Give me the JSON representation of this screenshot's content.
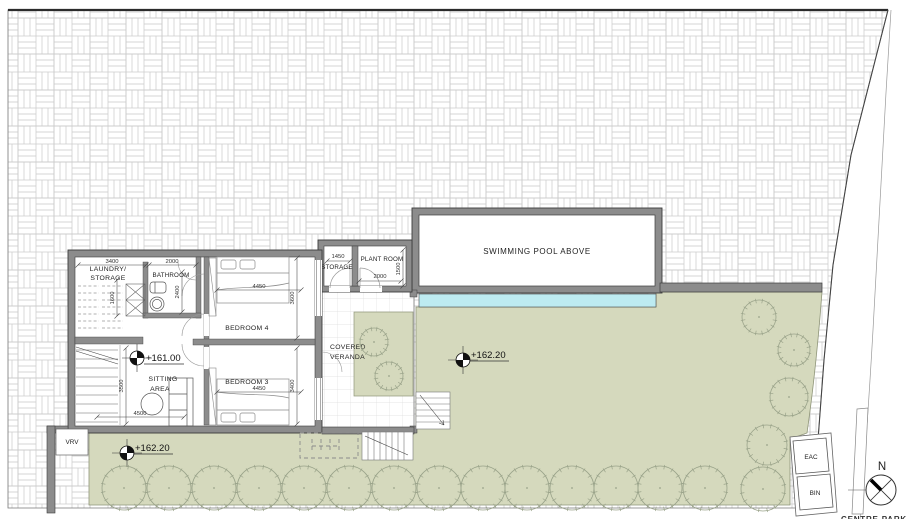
{
  "drawing": {
    "type": "architectural floor / site plan",
    "caption_bottom": "CENTRE PARK",
    "north_label": "N"
  },
  "rooms": {
    "laundry_line1": "LAUNDRY/",
    "laundry_line2": "STORAGE",
    "bathroom": "BATHROOM",
    "bedroom4": "BEDROOM 4",
    "bedroom3": "BEDROOM 3",
    "sitting_line1": "SITTING",
    "sitting_line2": "AREA",
    "storage": "STORAGE",
    "plant_room": "PLANT ROOM",
    "veranda_line1": "COVERED",
    "veranda_line2": "VERANDA",
    "pool": "SWIMMING POOL ABOVE"
  },
  "levels": {
    "upper_floor": "+161.00",
    "garden": "+162.20",
    "lower_garden": "+162.20"
  },
  "annotations": {
    "vrv": "VRV",
    "eac": "EAC",
    "bin": "BIN"
  },
  "dimensions": {
    "laundry_w": "3400",
    "laundry_d": "1600",
    "bathroom_w": "2000",
    "bathroom_h": "2400",
    "bedroom4_w": "4450",
    "bedroom4_h": "3600",
    "bedroom3_w": "4450",
    "bedroom3_h": "3400",
    "sitting_h": "3500",
    "sitting_w": "4500",
    "storage_w": "1450",
    "plant_w": "2000",
    "plant_h": "1500"
  },
  "colors": {
    "grass": "#d5d9bd",
    "grass_edge": "#8f9579",
    "pool_water": "#bdebf1",
    "wall_fill": "#8c8c8c",
    "wall_outline": "#3c3c3c",
    "paving_line": "#c9c9c9",
    "tree_stroke": "#9aa38a"
  },
  "trees": {
    "bottom_row_r": 22,
    "bottom_row": [
      [
        124,
        488
      ],
      [
        169,
        488
      ],
      [
        214,
        488
      ],
      [
        259,
        488
      ],
      [
        304,
        488
      ],
      [
        349,
        488
      ],
      [
        394,
        488
      ],
      [
        439,
        488
      ],
      [
        483,
        488
      ],
      [
        527,
        488
      ],
      [
        572,
        488
      ],
      [
        616,
        488
      ],
      [
        660,
        488
      ],
      [
        705,
        488
      ],
      [
        763,
        489
      ]
    ],
    "right_side": [
      [
        759,
        317,
        17
      ],
      [
        794,
        350,
        16
      ],
      [
        789,
        397,
        19
      ],
      [
        767,
        445,
        20
      ]
    ],
    "planter": [
      [
        374,
        342,
        14
      ],
      [
        389,
        376,
        14
      ]
    ]
  }
}
